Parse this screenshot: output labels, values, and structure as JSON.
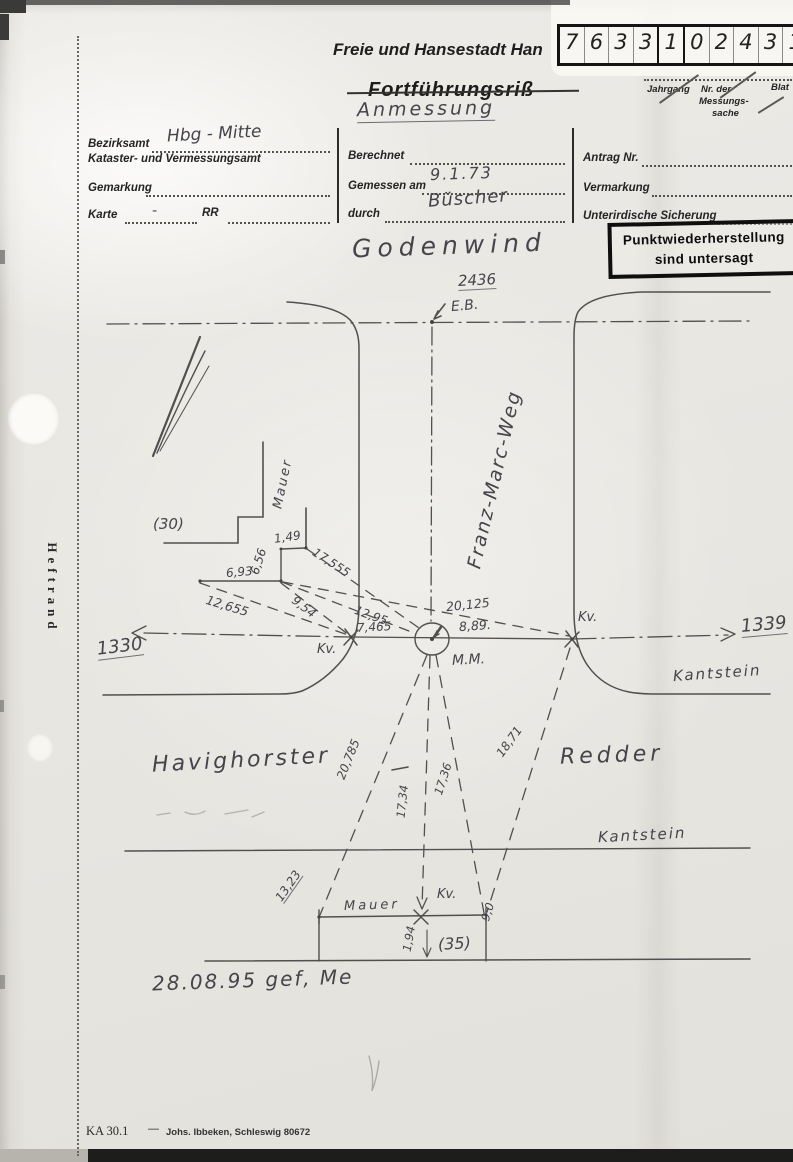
{
  "header": {
    "agency": "Freie und Hansestadt Han",
    "title": "Fortführungsriß",
    "title_hw": "Anmessung",
    "digits": [
      "7",
      "6",
      "3",
      "3",
      "1",
      "0",
      "2",
      "4",
      "3",
      "1"
    ],
    "jahrgang": "Jahrgang",
    "nr_der": "Nr. der",
    "messungs": "Messungs-",
    "sache": "sache",
    "blatt": "Blat"
  },
  "form": {
    "bezirksamt_label": "Bezirksamt",
    "bezirksamt_value": "Hbg - Mitte",
    "amt_label": "Kataster- und Vermessungsamt",
    "gemarkung_label": "Gemarkung",
    "karte_label": "Karte",
    "karte_value": "-",
    "karte_rr": "RR",
    "berechnet_label": "Berechnet",
    "gemessen_label": "Gemessen am",
    "gemessen_value": "9.1.73",
    "durch_label": "durch",
    "durch_value": "Büscher",
    "antrag_label": "Antrag Nr.",
    "vermarkung_label": "Vermarkung",
    "sicherung_label": "Unterirdische Sicherung",
    "stamp_line1": "Punktwiederherstellung",
    "stamp_line2": "sind untersagt"
  },
  "drawing": {
    "street_top": "Godenwind",
    "parcel_top": "2436",
    "eb": "E.B.",
    "street_vertical": "Franz-Marc-Weg",
    "street_left": "Havighorster",
    "street_right": "Redder",
    "kantstein1": "Kantstein",
    "kantstein2": "Kantstein",
    "point_left": "1330",
    "point_right": "1339",
    "kv1": "Kv.",
    "kv2": "Kv.",
    "kv3": "Kv.",
    "mm": "M.M.",
    "mauer1": "Mauer",
    "mauer2": "Mauer",
    "parcel30": "(30)",
    "parcel35": "(35)",
    "m_149": "1,49",
    "m_656": "6,56",
    "m_693": "6,93",
    "m_17555": "17,555",
    "m_12655": "12,655",
    "m_954": "9,54",
    "m_1295": "12,95",
    "m_20125": "20,125",
    "m_7465": "7,465",
    "m_889": "8,89.",
    "m_20785": "20,785",
    "m_1734": "17,34",
    "m_1736": "17,36",
    "m_1871": "18,71",
    "m_1323": "13,23",
    "m_90": "9,0",
    "m_194": "1,94",
    "note": "28.08.95 gef, Me"
  },
  "margin": {
    "heftrand": "Heftrand"
  },
  "footer": {
    "ka": "KA 30.1",
    "dash": "—",
    "printer": "Johs. Ibbeken, Schleswig  80672"
  }
}
